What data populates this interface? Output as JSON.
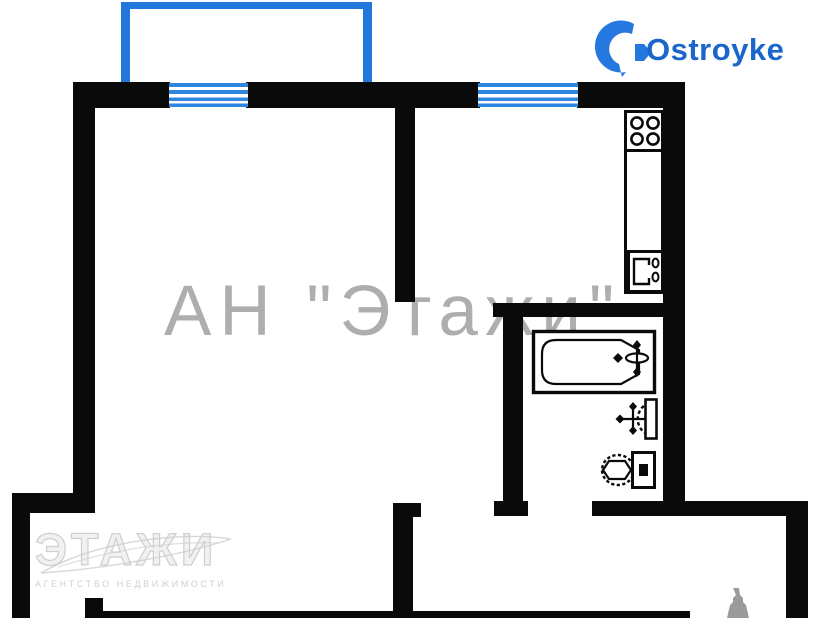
{
  "branding": {
    "logo_text": "Ostroyke",
    "logo_text_color": "#1b66cb",
    "logo_icon": "ostroyke-house-icon",
    "logo_icon_color": "#2478e0"
  },
  "watermarks": {
    "center": {
      "text": "АН \"Этажи\"",
      "color": "#7d7d7d"
    },
    "bottom": {
      "logo_text": "ЭТАЖИ",
      "subtext": "АГЕНТСТВО НЕДВИЖИМОСТИ",
      "color": "#c9c9c9"
    }
  },
  "floorplan": {
    "background_color": "#ffffff",
    "wall_color": "#0a0a0a",
    "window_color": "#2e86de",
    "balcony_color": "#2277dd",
    "windows": [
      "living-room-window",
      "kitchen-window"
    ],
    "features": [
      "balcony-outline",
      "entry-alcove",
      "corridor"
    ],
    "fixtures": [
      "stove-burners",
      "kitchen-sink",
      "bathtub",
      "washbasin",
      "toilet"
    ]
  }
}
